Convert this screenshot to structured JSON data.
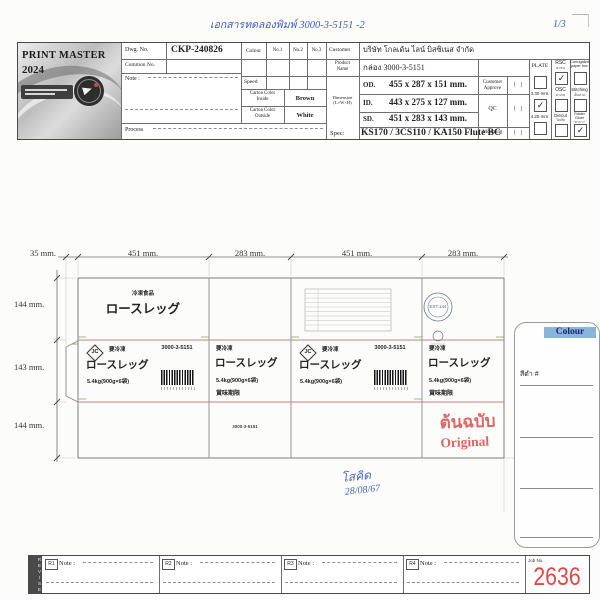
{
  "annotations": {
    "top_note": "เอกสารทดลองพิมพ์  3000-3-5151  -2",
    "page_no": "1/3",
    "signature": "โสคิด",
    "sign_date": "28/08/67"
  },
  "stamp": {
    "thai": "ต้นฉบับ",
    "eng": "Original"
  },
  "header": {
    "logo_title": "PRINT MASTER",
    "logo_year": "2024",
    "dwg_label": "Dwg. No.",
    "dwg_value": "CKP-240826",
    "common_label": "Common No.",
    "note_label": "Note :",
    "process_label": "Process",
    "colour_label": "Colour",
    "col_no1": "No.1",
    "col_no2": "No.2",
    "col_no3": "No.3",
    "speed_label": "Speed",
    "carton_inside_label": "Carton Color\nInside",
    "carton_inside_value": "Brown",
    "carton_outside_label": "Carton Color\nOutside",
    "carton_outside_value": "White",
    "customer_label": "Customer",
    "customer_value": "บริษัท โกลเด้น ไลน์ บิสซิเนส จำกัด",
    "product_label": "Product\nName",
    "product_value": "กล่อง 3000-3-5151",
    "dimension_label": "Dimension\n(L×W×H)",
    "rows": [
      {
        "k": "OD.",
        "v": "455 x 287 x 151 mm."
      },
      {
        "k": "ID.",
        "v": "443 x 275 x 127 mm."
      },
      {
        "k": "SD.",
        "v": "451 x 283 x 143 mm."
      }
    ],
    "spec_label": "Spec:",
    "spec_value": "KS170 / 3CS110 / KA150 Flute BC",
    "approve1": "Customer\nApprove",
    "approve2": "QC",
    "approve3": "Mounting",
    "paren": "(   )",
    "plate_label": "PLATE",
    "plate_mm1": "3.30 mm.",
    "plate_mm2": "4.25 mm.",
    "check": "✓",
    "opt_rsc": "RSC",
    "opt_rsc_sub": "ฝาชน",
    "opt_box": "Corrugated\npaper box",
    "opt_osc": "OSC",
    "opt_osc_sub": "ฝาเกย",
    "opt_stitch": "Stitching",
    "opt_stitch_sub": "เย็บลวด",
    "opt_diecut": "Diecut",
    "opt_diecut_sub": "ไดคัท",
    "opt_gluer": "Folder Gluer",
    "opt_gluer_sub": "ทากาว"
  },
  "drawing": {
    "dim_flap": "35 mm.",
    "dim_w1": "451 mm.",
    "dim_w2": "283 mm.",
    "dim_w3": "451 mm.",
    "dim_w4": "283 mm.",
    "dim_h1": "144 mm.",
    "dim_h2": "143 mm.",
    "dim_h3": "144 mm.",
    "top_small": "冷凍食品",
    "top_big": "ロースレッグ",
    "jc": "JC",
    "keep_frozen": "要冷凍",
    "code": "3000-3-5151",
    "name": "ロースレッグ",
    "weight": "5.4kg(900g×6袋)",
    "expiry": "賞味期限",
    "est_stamp": "EST.144",
    "bottom_code": "3000-3-5151"
  },
  "colour_box": {
    "title": "Colour",
    "swatch_label": "สีดำ #"
  },
  "revise": {
    "side_label": "REVISE",
    "note_label": "Note :",
    "tags": [
      "R1",
      "R2",
      "R3",
      "R4"
    ],
    "job_label": "Job No.",
    "job_value": "2636"
  }
}
